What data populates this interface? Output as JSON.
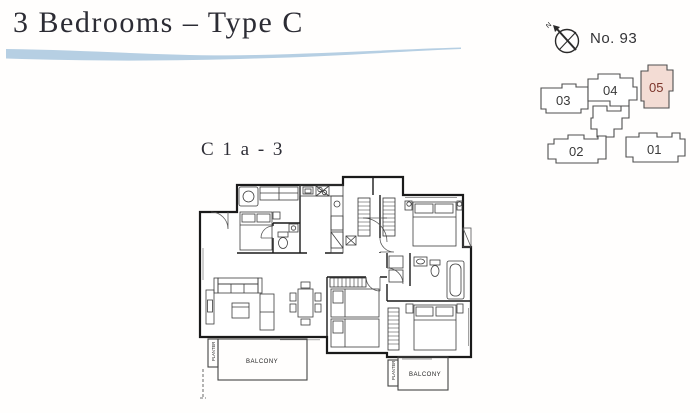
{
  "header": {
    "title": "3 Bedrooms – Type C"
  },
  "floorplan": {
    "code": "C 1 a - 3",
    "labels": {
      "balcony_left": "BALCONY",
      "balcony_right": "BALCONY",
      "planter_left": "PLANTER",
      "planter_right": "PLANTER"
    }
  },
  "keyplan": {
    "number_label": "No. 93",
    "compass_label": "N",
    "highlighted_unit": "05",
    "highlight_fill": "#f3dcd4",
    "highlight_stroke": "#8a6a60",
    "highlight_text": "#7c352b",
    "units": [
      {
        "label": "03"
      },
      {
        "label": "04"
      },
      {
        "label": "05"
      },
      {
        "label": "02"
      },
      {
        "label": "01"
      }
    ]
  },
  "colors": {
    "swoosh": "#b6cfe3",
    "walls": "#1a1a1a"
  }
}
